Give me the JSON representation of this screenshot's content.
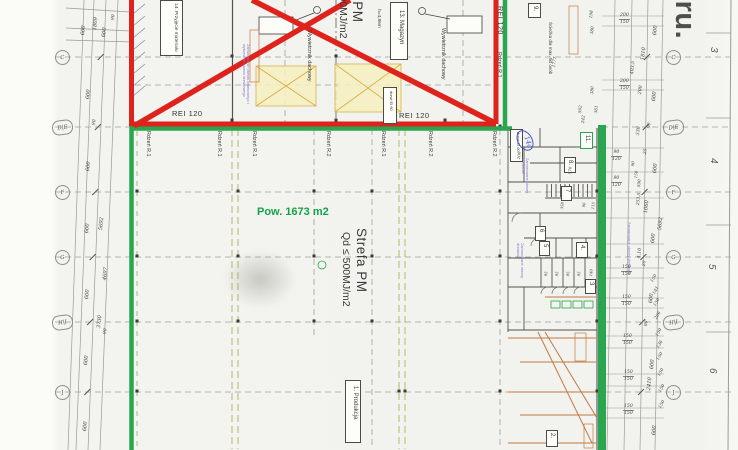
{
  "drawing": {
    "title_fragment": "eru.",
    "area_label": "Pow. 1673 m2",
    "zone": {
      "name": "Strefa PM",
      "load": "Qd ≤ 500MJ/m2"
    },
    "height_note": "h=4,86m",
    "path_note": "Ścieżka dla max. 50 osób",
    "vent_label": "Wywietrznik dachowy",
    "door_label": "drzwi EI 60",
    "fire_rating": "REI 120",
    "core1": "Rdzeń R.1",
    "core2": "Rdzeń R.2",
    "note_bricked": "Zamurowane otwory drzwiowe",
    "note_gate": "Zamurowanie otworu bramowego i wykonanie otworu drzwiowego",
    "rooms": {
      "production": "1. Produkcja",
      "storage": "13. Magazyn",
      "receiving": "14. Przyjęcie materiału",
      "r2": "2.",
      "r3": "3",
      "r4": "4.",
      "r5": "5",
      "r6": "6",
      "r7": "7",
      "r8": "8.",
      "r9": "9.",
      "r11": "11.",
      "r14a": "14a"
    },
    "stall_dims": [
      "95",
      "95",
      "95",
      "95",
      "140"
    ]
  },
  "grid": {
    "rows": [
      "C",
      "D|E",
      "F",
      "G",
      "H|I",
      "J"
    ],
    "sheet_numbers": [
      "3",
      "4",
      "5",
      "6"
    ]
  },
  "dimensions": {
    "placed": [
      {
        "t": "600",
        "x": 80,
        "y": 22
      },
      {
        "t": "1809",
        "x": 92,
        "y": 14
      },
      {
        "t": "600",
        "x": 101,
        "y": 24
      },
      {
        "t": "90",
        "x": 111,
        "y": 11,
        "s": 4.6
      },
      {
        "t": "600",
        "x": 85,
        "y": 86
      },
      {
        "t": "90",
        "x": 92,
        "y": 116,
        "s": 4.6
      },
      {
        "t": "600",
        "x": 85,
        "y": 158
      },
      {
        "t": "600",
        "x": 84,
        "y": 220
      },
      {
        "t": "5692",
        "x": 98,
        "y": 214
      },
      {
        "t": "600",
        "x": 84,
        "y": 286
      },
      {
        "t": "4697",
        "x": 102,
        "y": 264
      },
      {
        "t": "3730",
        "x": 96,
        "y": 312
      },
      {
        "t": "90",
        "x": 103,
        "y": 325,
        "s": 4.6
      },
      {
        "t": "600",
        "x": 83,
        "y": 352
      },
      {
        "t": "600",
        "x": 82,
        "y": 418
      },
      {
        "t": "600",
        "x": 652,
        "y": 22
      },
      {
        "t": "1810",
        "x": 640,
        "y": 44
      },
      {
        "t": "403,5",
        "x": 630,
        "y": 57,
        "s": 4.6
      },
      {
        "t": "600",
        "x": 651,
        "y": 88
      },
      {
        "t": "200",
        "x": 638,
        "y": 82,
        "s": 4.6
      },
      {
        "t": "90",
        "x": 647,
        "y": 120,
        "s": 4.4
      },
      {
        "t": "530",
        "x": 636,
        "y": 123,
        "s": 4.6
      },
      {
        "t": "25",
        "x": 643,
        "y": 146,
        "s": 4.4
      },
      {
        "t": "600",
        "x": 652,
        "y": 160
      },
      {
        "t": "90",
        "x": 630,
        "y": 158,
        "s": 4
      },
      {
        "t": "150",
        "x": 633,
        "y": 168,
        "s": 4
      },
      {
        "t": "590",
        "x": 636,
        "y": 176,
        "s": 4.2
      },
      {
        "t": "253,5",
        "x": 636,
        "y": 188,
        "s": 4.4
      },
      {
        "t": "1060",
        "x": 643,
        "y": 197
      },
      {
        "t": "5692",
        "x": 657,
        "y": 214
      },
      {
        "t": "600",
        "x": 650,
        "y": 230
      },
      {
        "t": "4,10",
        "x": 637,
        "y": 244,
        "s": 4.6
      },
      {
        "t": "20",
        "x": 642,
        "y": 258,
        "s": 4.4
      },
      {
        "t": "150",
        "x": 650,
        "y": 270,
        "r": -60,
        "s": 4.4
      },
      {
        "t": "141",
        "x": 652,
        "y": 282,
        "r": -60,
        "s": 4.4
      },
      {
        "t": "150",
        "x": 653,
        "y": 294,
        "r": -60,
        "s": 4.4
      },
      {
        "t": "206",
        "x": 654,
        "y": 307,
        "r": -60,
        "s": 4.4
      },
      {
        "t": "90",
        "x": 644,
        "y": 318,
        "s": 4.4
      },
      {
        "t": "600",
        "x": 648,
        "y": 290
      },
      {
        "t": "150",
        "x": 655,
        "y": 324,
        "r": -60,
        "s": 4.4
      },
      {
        "t": "136",
        "x": 656,
        "y": 336,
        "r": -60,
        "s": 4.4
      },
      {
        "t": "150",
        "x": 656,
        "y": 348,
        "r": -60,
        "s": 4.4
      },
      {
        "t": "600",
        "x": 649,
        "y": 356
      },
      {
        "t": "150",
        "x": 657,
        "y": 364,
        "r": -60,
        "s": 4.4
      },
      {
        "t": "2410",
        "x": 646,
        "y": 374
      },
      {
        "t": "150",
        "x": 658,
        "y": 380,
        "r": -60,
        "s": 4.4
      },
      {
        "t": "150",
        "x": 658,
        "y": 396,
        "r": -60,
        "s": 4.4
      },
      {
        "t": "600",
        "x": 651,
        "y": 422
      },
      {
        "t": "198",
        "x": 588,
        "y": 7,
        "s": 4.2
      },
      {
        "t": "380",
        "x": 589,
        "y": 23,
        "s": 4.2
      },
      {
        "t": "1777",
        "x": 551,
        "y": 54,
        "s": 4.2
      },
      {
        "t": "380",
        "x": 589,
        "y": 83,
        "s": 4.2
      },
      {
        "t": "592",
        "x": 577,
        "y": 102,
        "s": 4.2
      },
      {
        "t": "361",
        "x": 593,
        "y": 102,
        "s": 4.2
      },
      {
        "t": "242",
        "x": 580,
        "y": 112,
        "s": 4.2
      },
      {
        "t": "570",
        "x": 567,
        "y": 164,
        "s": 4
      },
      {
        "t": "200",
        "x": 516,
        "y": 149,
        "s": 4
      },
      {
        "t": "358",
        "x": 559,
        "y": 199,
        "s": 3.8
      },
      {
        "t": "96",
        "x": 581,
        "y": 199,
        "s": 3.8
      },
      {
        "t": "115",
        "x": 590,
        "y": 199,
        "s": 3.8
      }
    ],
    "pairs": [
      {
        "a": "200",
        "b": "150",
        "x": 619,
        "y": 13
      },
      {
        "a": "200",
        "b": "150",
        "x": 619,
        "y": 79
      },
      {
        "a": "90",
        "b": "120",
        "x": 611,
        "y": 150
      },
      {
        "a": "90",
        "b": "120",
        "x": 611,
        "y": 176
      },
      {
        "a": "150",
        "b": "150",
        "x": 621,
        "y": 265
      },
      {
        "a": "150",
        "b": "150",
        "x": 621,
        "y": 295
      },
      {
        "a": "150",
        "b": "150",
        "x": 622,
        "y": 334
      },
      {
        "a": "150",
        "b": "150",
        "x": 623,
        "y": 370
      },
      {
        "a": "150",
        "b": "150",
        "x": 623,
        "y": 404
      }
    ]
  },
  "colors": {
    "crossout_red": "#de231c",
    "boundary_green": "#29a64f",
    "area_text_green": "#17a14b",
    "note_purple": "#8a76cf",
    "equipment_orange": "#c17a42",
    "ink": "#4a4a48"
  }
}
